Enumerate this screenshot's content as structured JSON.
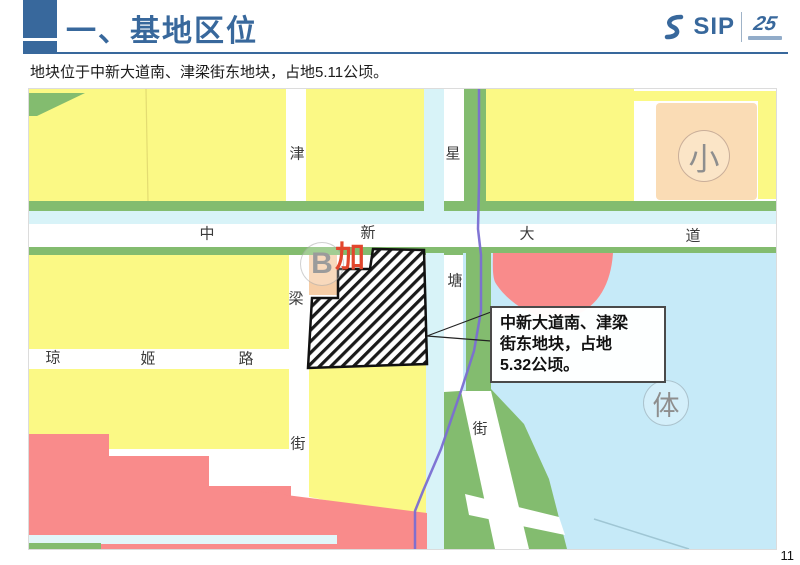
{
  "header": {
    "title": "一、基地区位",
    "logo_sip": "SIP",
    "logo_anniversary": "25"
  },
  "intro": "地块位于中新大道南、津梁街东地块，占地5.11公顷。",
  "page_number": "11",
  "map": {
    "callout": {
      "full_text": "中新大道南、津梁街东地块，占地5.32公顷。",
      "line1": "中新大道南、津梁",
      "line2": "街东地块，占地",
      "line3": "5.32公顷。"
    },
    "road_labels": {
      "zhong": "中",
      "xin": "新",
      "da": "大",
      "dao": "道",
      "jin": "津",
      "liang": "梁",
      "jie_left": "街",
      "xing": "星",
      "tang": "塘",
      "jie_right": "街",
      "qiong": "琼",
      "ji": "姬",
      "lu": "路"
    },
    "poi_labels": {
      "school": "小",
      "sports": "体",
      "b_marker": "B",
      "jia": "加"
    },
    "colors": {
      "yellow": "#FBF985",
      "pink": "#F98B8B",
      "peach": "#FADCB5",
      "peach2": "#F6CDA6",
      "green": "#83BC6F",
      "water": "#C6EAF8",
      "canal": "#D8F3F8",
      "canal2": "#E2F6F9",
      "rail": "#7A6ED2",
      "accent": "#38689C"
    }
  }
}
